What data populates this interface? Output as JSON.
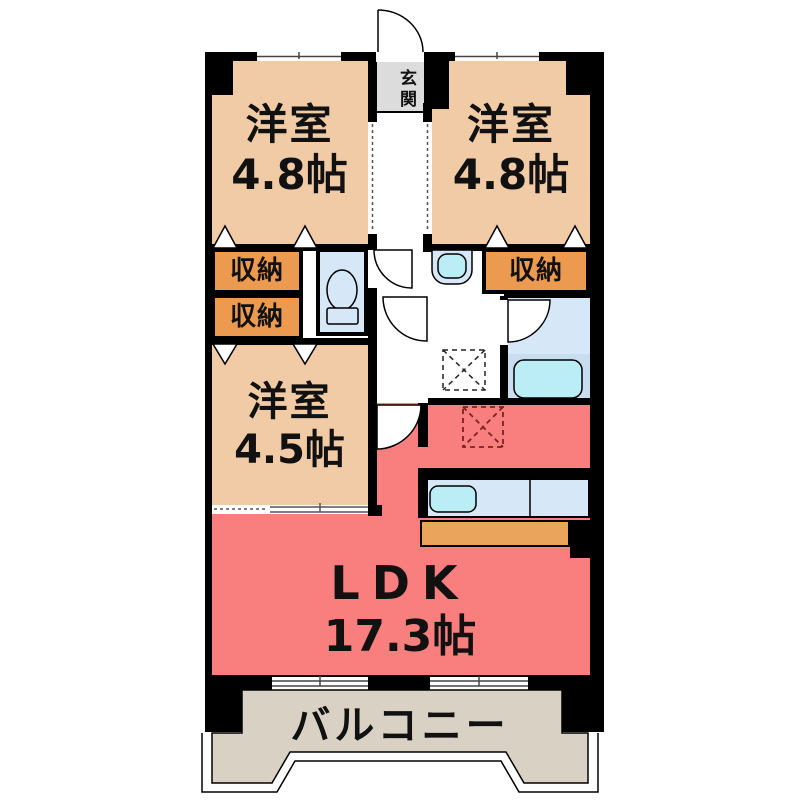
{
  "plan": {
    "entrance": {
      "label": "玄関"
    },
    "bedroom_nw": {
      "name": "洋室",
      "area": "4.8帖"
    },
    "bedroom_ne": {
      "name": "洋室",
      "area": "4.8帖"
    },
    "bedroom_w": {
      "name": "洋室",
      "area": "4.5帖"
    },
    "ldk": {
      "name": "LDK",
      "area": "17.3帖"
    },
    "balcony": {
      "label": "バルコニー"
    },
    "storage_label": "収納"
  },
  "colors": {
    "wall": "#000000",
    "room_tan": "#f0cba5",
    "storage_orange": "#ec9a4f",
    "ldk_red": "#f97f7f",
    "entrance_gray": "#dcdcdc",
    "wet_blue": "#d6e7f7",
    "bath_lower_blue": "#c9ddf0",
    "fixture_cyan": "#baedf5",
    "counter_orange": "#eba45c",
    "balcony_beige": "#d9d2c4",
    "line": "#000000"
  }
}
